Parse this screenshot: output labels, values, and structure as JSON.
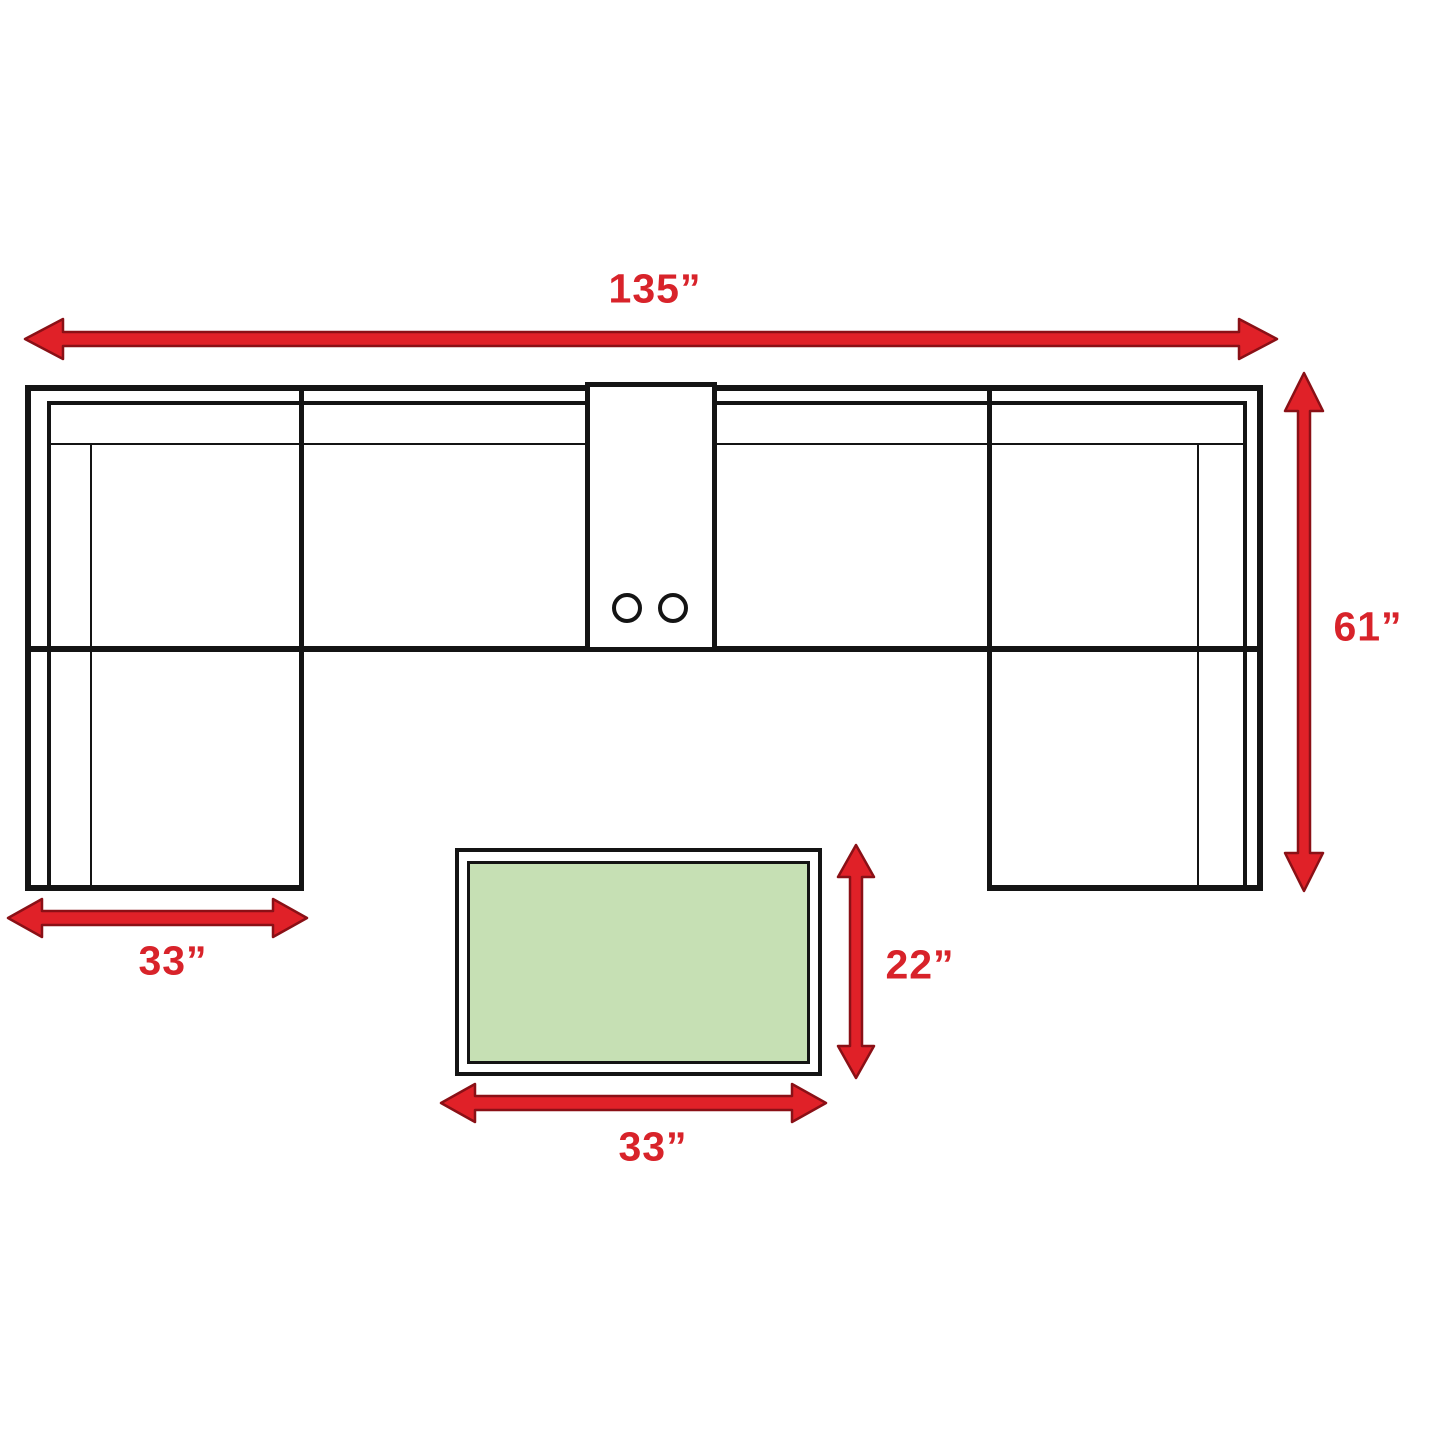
{
  "colors": {
    "background": "#ffffff",
    "line": "#141414",
    "arrow_fill": "#e02128",
    "arrow_outline": "#8a1016",
    "label_text": "#d8232a",
    "table_fill": "#c6e0b4"
  },
  "labels": {
    "sofa_width": "135”",
    "sofa_depth": "61”",
    "chaise_width": "33”",
    "table_depth": "22”",
    "table_width": "33”"
  }
}
